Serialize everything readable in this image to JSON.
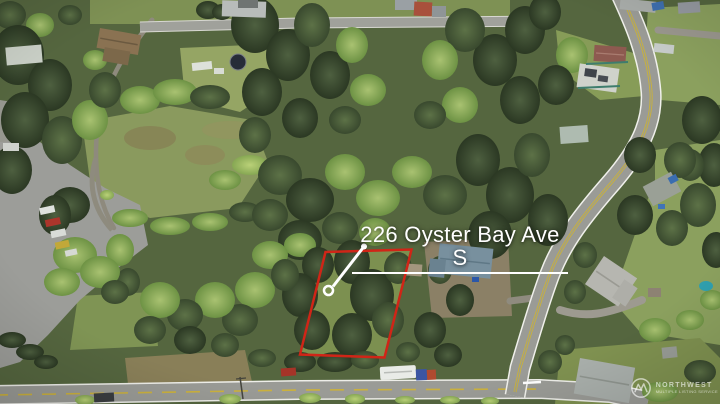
{
  "annotation": {
    "address_label": "226 Oyster Bay Ave S"
  },
  "watermark": {
    "logo_icon": "mountain-circle-icon",
    "brand": "NORTHWEST",
    "tagline": "MULTIPLE LISTING SERVICE"
  },
  "colors": {
    "property_outline": "#d02517",
    "annotation_text": "#ffffff",
    "leader_line": "#ffffff"
  }
}
